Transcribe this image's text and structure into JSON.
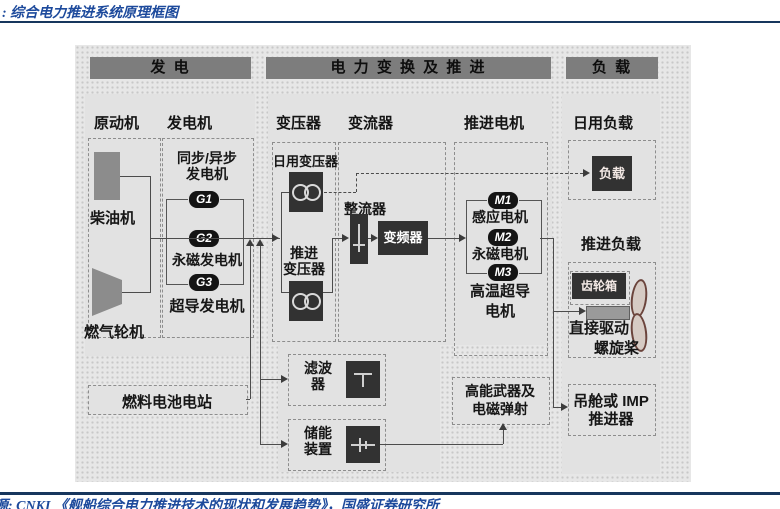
{
  "colors": {
    "accent_blue": "#1d4a9c",
    "rule_navy": "#17365d",
    "section_bar_gray": "#7d7d7d",
    "panel_gray": "#e2e2e2",
    "dark_box": "#323232"
  },
  "title": ": 综合电力推进系统原理框图",
  "footer": "源: CNKI 《舰船综合电力推进技术的现状和发展趋势》，国盛证券研究所",
  "sections": {
    "generation": "发  电",
    "conversion": "电 力 变 换 及 推 进",
    "load": "负  载"
  },
  "columns": {
    "prime_mover": "原动机",
    "generator": "发电机",
    "transformer": "变压器",
    "converter": "变流器",
    "propulsion_motor": "推进电机",
    "daily_load": "日用负载"
  },
  "generation": {
    "diesel": "柴油机",
    "gas_turbine": "燃气轮机",
    "sync_async_1": "同步/异步",
    "sync_async_2": "发电机",
    "g1": "G1",
    "g2": "G2",
    "g3": "G3",
    "pm_gen": "永磁发电机",
    "sc_gen": "超导发电机",
    "fuel_cell": "燃料电池电站"
  },
  "conversion": {
    "daily_xfmr": "日用变压器",
    "prop_xfmr_1": "推进",
    "prop_xfmr_2": "变压器",
    "rectifier": "整流器",
    "inverter": "变频器",
    "filter_1": "滤波",
    "filter_2": "器",
    "storage_1": "储能",
    "storage_2": "装置",
    "weapon_1": "高能武器及",
    "weapon_2": "电磁弹射"
  },
  "motors": {
    "m1": "M1",
    "m2": "M2",
    "m3": "M3",
    "induction": "感应电机",
    "pm": "永磁电机",
    "hts_1": "高温超导",
    "hts_2": "电机"
  },
  "load": {
    "daily_box": "负载",
    "propulsion_load": "推进负载",
    "gearbox": "齿轮箱",
    "direct_drive": "直接驱动",
    "propeller": "螺旋桨",
    "pod_1": "吊舱或 IMP",
    "pod_2": "推进器"
  }
}
